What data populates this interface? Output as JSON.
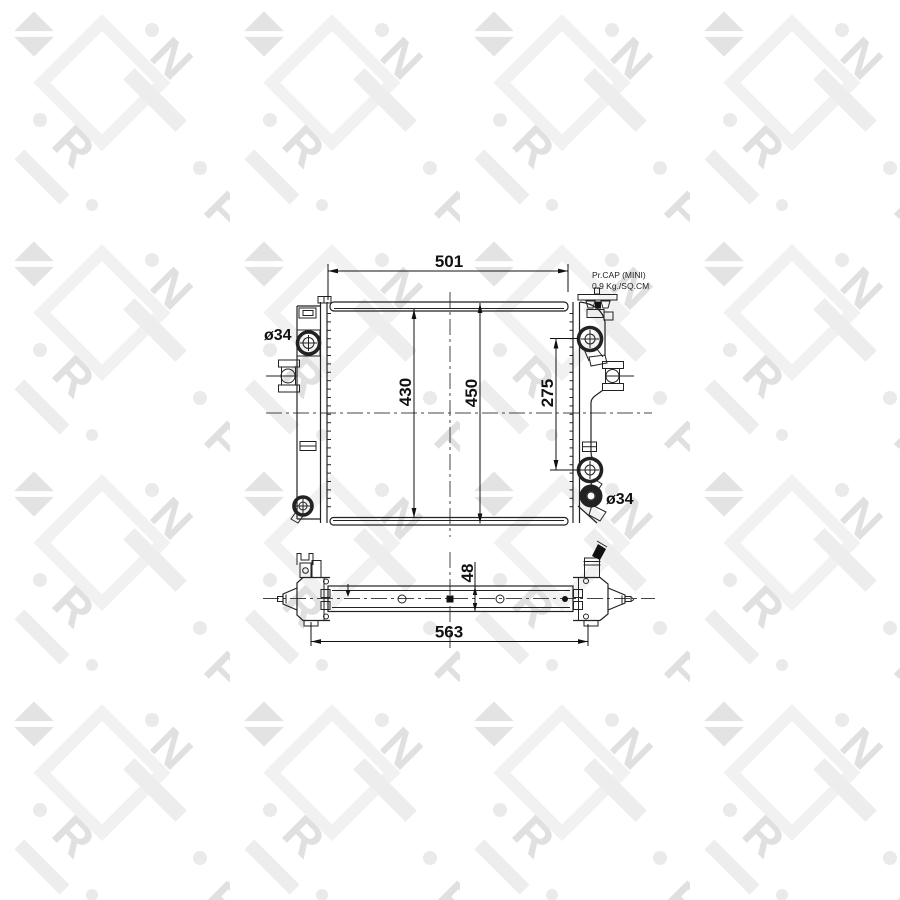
{
  "watermark": {
    "letters": [
      "N",
      "R",
      "F"
    ]
  },
  "colors": {
    "line": "#222222",
    "text": "#111111",
    "watermark": "#e0e0e0"
  },
  "front_view": {
    "dim_width": "501",
    "dim_core_height": "430",
    "dim_overall_height": "450",
    "dim_port_span": "275",
    "label_port_left": "ø34",
    "label_port_right": "ø34",
    "cap_note_line1": "Pr.CAP (MINI)",
    "cap_note_line2": "0.9 Kg./SQ.CM"
  },
  "side_view": {
    "dim_thickness": "48",
    "dim_overall_width": "563"
  }
}
